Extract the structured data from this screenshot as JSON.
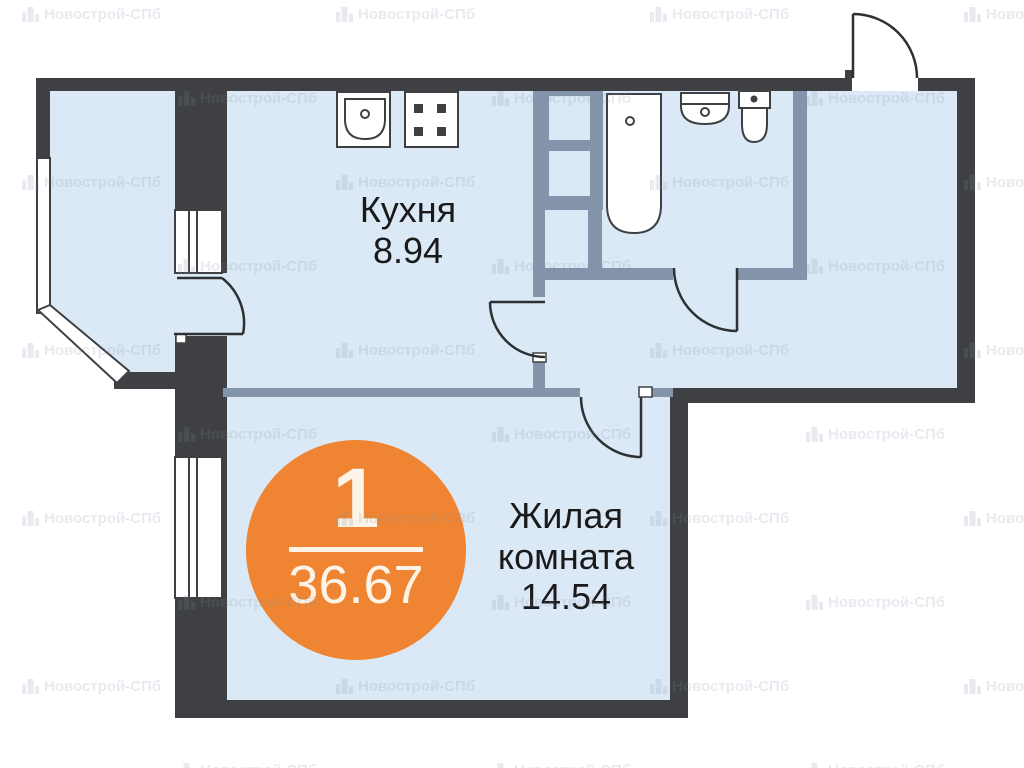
{
  "watermark": {
    "text": "Новострой-СПб",
    "icon": "buildings-icon"
  },
  "badge": {
    "number": "1",
    "area": "36.67"
  },
  "rooms": {
    "kitchen": {
      "name": "Кухня",
      "area": "8.94"
    },
    "living": {
      "name": "Жилая комната",
      "area": "14.54"
    }
  },
  "fixtures": {
    "kitchen": [
      "kitchen-sink",
      "stove"
    ],
    "bathroom": [
      "bathtub",
      "washbasin",
      "toilet"
    ]
  },
  "colors": {
    "room_fill": "#dbe9f6",
    "wall_dark": "#3f4043",
    "wall_partition": "#8494ab",
    "badge_orange": "#ef8532",
    "badge_text": "#fdf3e6",
    "label_text": "#1a1a1a",
    "watermark_color": "rgba(125,140,165,0.18)"
  }
}
